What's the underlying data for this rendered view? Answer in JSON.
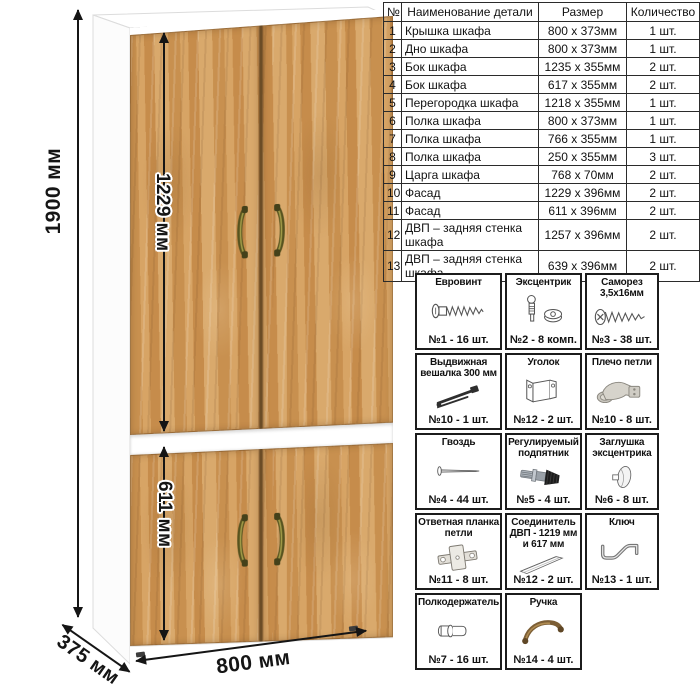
{
  "drawing": {
    "dim_height": "1900 мм",
    "dim_upper_door": "1229 мм",
    "dim_lower_door": "611 мм",
    "dim_width": "800 мм",
    "dim_depth": "375 мм"
  },
  "parts_table": {
    "headers": [
      "№",
      "Наименование детали",
      "Размер",
      "Количество"
    ],
    "rows": [
      {
        "num": "1",
        "name": "Крышка шкафа",
        "size": "800 х 373мм",
        "qty": "1 шт."
      },
      {
        "num": "2",
        "name": "Дно шкафа",
        "size": "800 х 373мм",
        "qty": "1 шт."
      },
      {
        "num": "3",
        "name": "Бок шкафа",
        "size": "1235 х 355мм",
        "qty": "2 шт."
      },
      {
        "num": "4",
        "name": "Бок шкафа",
        "size": "617 х 355мм",
        "qty": "2 шт."
      },
      {
        "num": "5",
        "name": "Перегородка шкафа",
        "size": "1218 х 355мм",
        "qty": "1 шт."
      },
      {
        "num": "6",
        "name": "Полка шкафа",
        "size": "800 х 373мм",
        "qty": "1 шт."
      },
      {
        "num": "7",
        "name": "Полка шкафа",
        "size": "766 х 355мм",
        "qty": "1 шт."
      },
      {
        "num": "8",
        "name": "Полка шкафа",
        "size": "250 х 355мм",
        "qty": "3 шт."
      },
      {
        "num": "9",
        "name": "Царга шкафа",
        "size": "768 х 70мм",
        "qty": "2 шт."
      },
      {
        "num": "10",
        "name": "Фасад",
        "size": "1229 х 396мм",
        "qty": "2 шт."
      },
      {
        "num": "11",
        "name": "Фасад",
        "size": "611 х 396мм",
        "qty": "2 шт."
      },
      {
        "num": "12",
        "name": "ДВП – задняя стенка шкафа",
        "size": "1257 х 396мм",
        "qty": "2 шт."
      },
      {
        "num": "13",
        "name": "ДВП – задняя стенка шкафа",
        "size": "639 х 396мм",
        "qty": "2 шт."
      }
    ]
  },
  "hardware": [
    {
      "title": "Евровинт",
      "count": "№1 - 16 шт.",
      "icon": "eurovint-screw-icon"
    },
    {
      "title": "Эксцентрик",
      "count": "№2 - 8 комп.",
      "icon": "cam-lock-icon"
    },
    {
      "title": "Саморез 3,5х16мм",
      "count": "№3 - 38 шт.",
      "icon": "self-tapping-screw-icon"
    },
    {
      "title": "Выдвижная вешалка 300 мм",
      "count": "№10 - 1 шт.",
      "icon": "pullout-hanger-icon"
    },
    {
      "title": "Уголок",
      "count": "№12 - 2 шт.",
      "icon": "corner-bracket-icon"
    },
    {
      "title": "Плечо петли",
      "count": "№10 - 8 шт.",
      "icon": "hinge-arm-icon"
    },
    {
      "title": "Гвоздь",
      "count": "№4 - 44 шт.",
      "icon": "nail-icon"
    },
    {
      "title": "Регулируемый подпятник",
      "count": "№5 - 4 шт.",
      "icon": "adjustable-foot-icon"
    },
    {
      "title": "Заглушка эксцентрика",
      "count": "№6 - 8 шт.",
      "icon": "cam-cover-icon"
    },
    {
      "title": "Ответная планка петли",
      "count": "№11 - 8 шт.",
      "icon": "hinge-plate-icon"
    },
    {
      "title": "Соединитель ДВП - 1219 мм и 617 мм",
      "count": "№12 - 2 шт.",
      "icon": "hdf-connector-icon"
    },
    {
      "title": "Ключ",
      "count": "№13 - 1 шт.",
      "icon": "hex-key-icon"
    },
    {
      "title": "Полкодержатель",
      "count": "№7 - 16 шт.",
      "icon": "shelf-pin-icon"
    },
    {
      "title": "Ручка",
      "count": "№14 - 4 шт.",
      "icon": "bow-handle-icon"
    }
  ],
  "colors": {
    "wood": "#cb9a61",
    "wood_gap": "#6b4c26",
    "handle_bronze": "#57531f",
    "line": "#151515"
  }
}
